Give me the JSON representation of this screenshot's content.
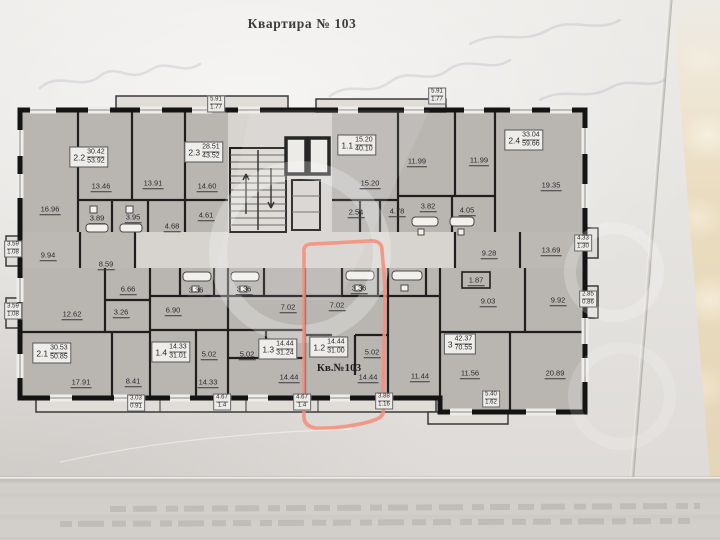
{
  "title": "Квартира № 103",
  "plan": {
    "highlight_label": "Кв.№103",
    "highlight_color": "#f5907e",
    "apartments": {
      "a22": {
        "id": "2.2",
        "living": "30.42",
        "total": "53.92",
        "rooms": [
          "16.96",
          "13.46",
          "3.89",
          "3.95"
        ]
      },
      "a23": {
        "id": "2.3",
        "living": "28.51",
        "total": "43.52",
        "rooms": [
          "13.91",
          "14.60",
          "4.68",
          "4.61"
        ]
      },
      "a11": {
        "id": "1.1",
        "living": "15.20",
        "total": "40.10",
        "rooms": [
          "15.20",
          "2.54",
          "4.78"
        ]
      },
      "a24": {
        "id": "2.4",
        "living": "33.04",
        "total": "59.66",
        "rooms": [
          "11.99",
          "11.99",
          "3.82",
          "4.05",
          "19.35"
        ]
      },
      "a21": {
        "id": "2.1",
        "living": "30.53",
        "total": "50.85",
        "rooms": [
          "9.94",
          "8.59",
          "6.66",
          "3.26",
          "12.62",
          "17.91",
          "8.41"
        ]
      },
      "a14": {
        "id": "1.4",
        "living": "14.33",
        "total": "31.01",
        "rooms": [
          "3.36",
          "6.90",
          "5.02",
          "14.33"
        ]
      },
      "a13": {
        "id": "1.3",
        "living": "14.44",
        "total": "31.24",
        "rooms": [
          "3.36",
          "7.02",
          "5.02",
          "14.44"
        ]
      },
      "a12": {
        "id": "1.2",
        "living": "14.44",
        "total": "31.00",
        "rooms": [
          "3.36",
          "7.02",
          "5.02",
          "14.44"
        ]
      },
      "a3": {
        "id": "3",
        "living": "42.37",
        "total": "70.55",
        "rooms": [
          "9.28",
          "13.69",
          "1.87",
          "9.03",
          "9.92",
          "11.44",
          "11.56",
          "20.89"
        ]
      }
    },
    "balconies": [
      {
        "a": "5.91",
        "b": "1.77"
      },
      {
        "a": "5.91",
        "b": "1.77"
      },
      {
        "a": "3.59",
        "b": "1.08"
      },
      {
        "a": "3.59",
        "b": "1.08"
      },
      {
        "a": "4.33",
        "b": "1.30"
      },
      {
        "a": "2.85",
        "b": "0.86"
      },
      {
        "a": "3.03",
        "b": "0.91"
      },
      {
        "a": "4.67",
        "b": "1.4"
      },
      {
        "a": "4.67",
        "b": "1.4"
      },
      {
        "a": "3.88",
        "b": "1.16"
      },
      {
        "a": "5.40",
        "b": "1.62"
      }
    ]
  }
}
